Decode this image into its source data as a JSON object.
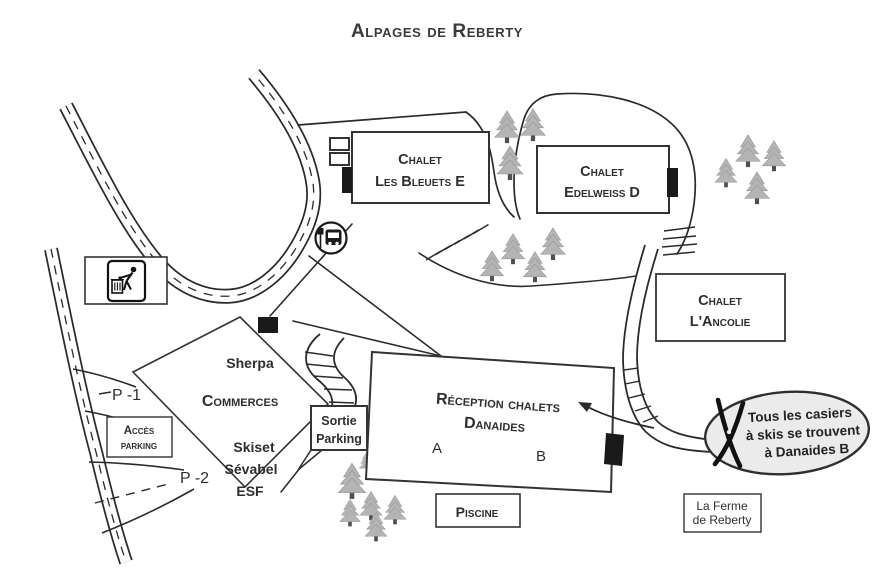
{
  "title": "Alpages de Reberty",
  "colors": {
    "line": "#2b2b2b",
    "tree_fill": "#b4b4b4",
    "tree_trunk": "#4f4f4f",
    "callout_fill": "#ebebeb"
  },
  "buildings": {
    "bleuets": {
      "line1": "Chalet",
      "line2": "Les Bleuets E"
    },
    "edelweiss": {
      "line1": "Chalet",
      "line2": "Edelweiss D"
    },
    "ancolie": {
      "line1": "Chalet",
      "line2": "L'Ancolie"
    },
    "danaides": {
      "line1": "Réception chalets",
      "line2": "Danaides",
      "wing_a": "A",
      "wing_b": "B"
    },
    "piscine": {
      "label": "Piscine"
    },
    "ferme": {
      "line1": "La Ferme",
      "line2": "de Reberty"
    },
    "commerces": {
      "title": "Commerces",
      "shops_top": "Sherpa",
      "shops_bottom": [
        "Skiset",
        "Sévabel",
        "ESF"
      ]
    }
  },
  "parking": {
    "access": {
      "line1": "Accès",
      "line2": "parking"
    },
    "exit": {
      "line1": "Sortie",
      "line2": "Parking"
    },
    "p1": "P -1",
    "p2": "P -2"
  },
  "callout": {
    "lines": [
      "Tous les casiers",
      "à skis se trouvent",
      "à Danaides B"
    ]
  },
  "icons": {
    "bus_stop": "bus-stop-icon",
    "waste": "waste-disposal-icon",
    "skis": "crossed-skis-icon",
    "tree": "pine-tree-icon"
  }
}
